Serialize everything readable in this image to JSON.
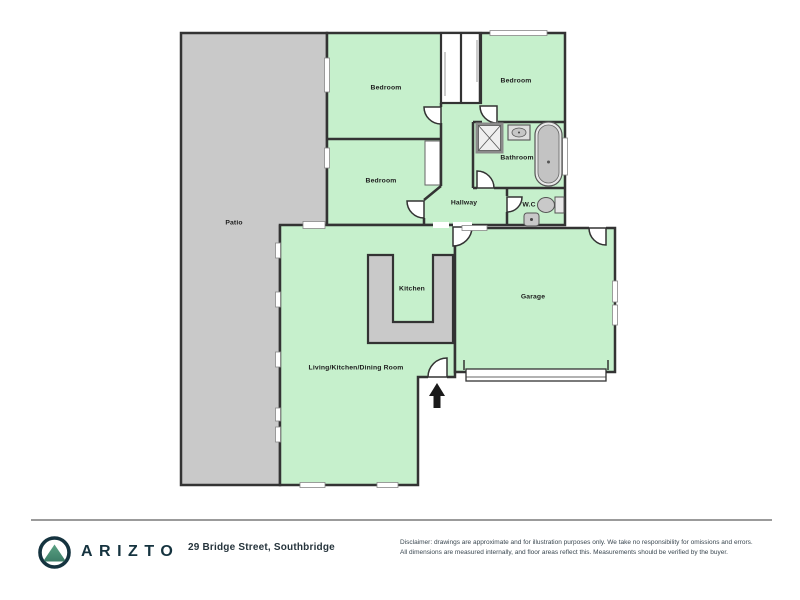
{
  "floor_plan": {
    "rooms": [
      {
        "id": "patio",
        "label": "Patio"
      },
      {
        "id": "bedroom-top",
        "label": "Bedroom"
      },
      {
        "id": "bedroom-right",
        "label": "Bedroom"
      },
      {
        "id": "bedroom-mid",
        "label": "Bedroom"
      },
      {
        "id": "hallway",
        "label": "Hallway"
      },
      {
        "id": "bathroom",
        "label": "Bathroom"
      },
      {
        "id": "wc",
        "label": "W.C"
      },
      {
        "id": "kitchen",
        "label": "Kitchen"
      },
      {
        "id": "garage",
        "label": "Garage"
      },
      {
        "id": "living",
        "label": "Living/Kitchen/Dining Room"
      }
    ],
    "colors": {
      "room_fill": "#c6f0cc",
      "outdoor_fill": "#c9c9c9",
      "counter_fill": "#c9c9c9",
      "wall": "#333333"
    }
  },
  "footer": {
    "brand": "ARIZTO",
    "address": "29 Bridge Street, Southbridge",
    "disclaimer_line1": "Disclaimer: drawings are approximate and for illustration purposes only. We take no responsibility for omissions and errors.",
    "disclaimer_line2": "All dimensions are measured internally, and floor areas reflect this. Measurements should be verified by the buyer.",
    "brand_color": "#15333f",
    "logo_mountain_color": "#4a9478"
  }
}
